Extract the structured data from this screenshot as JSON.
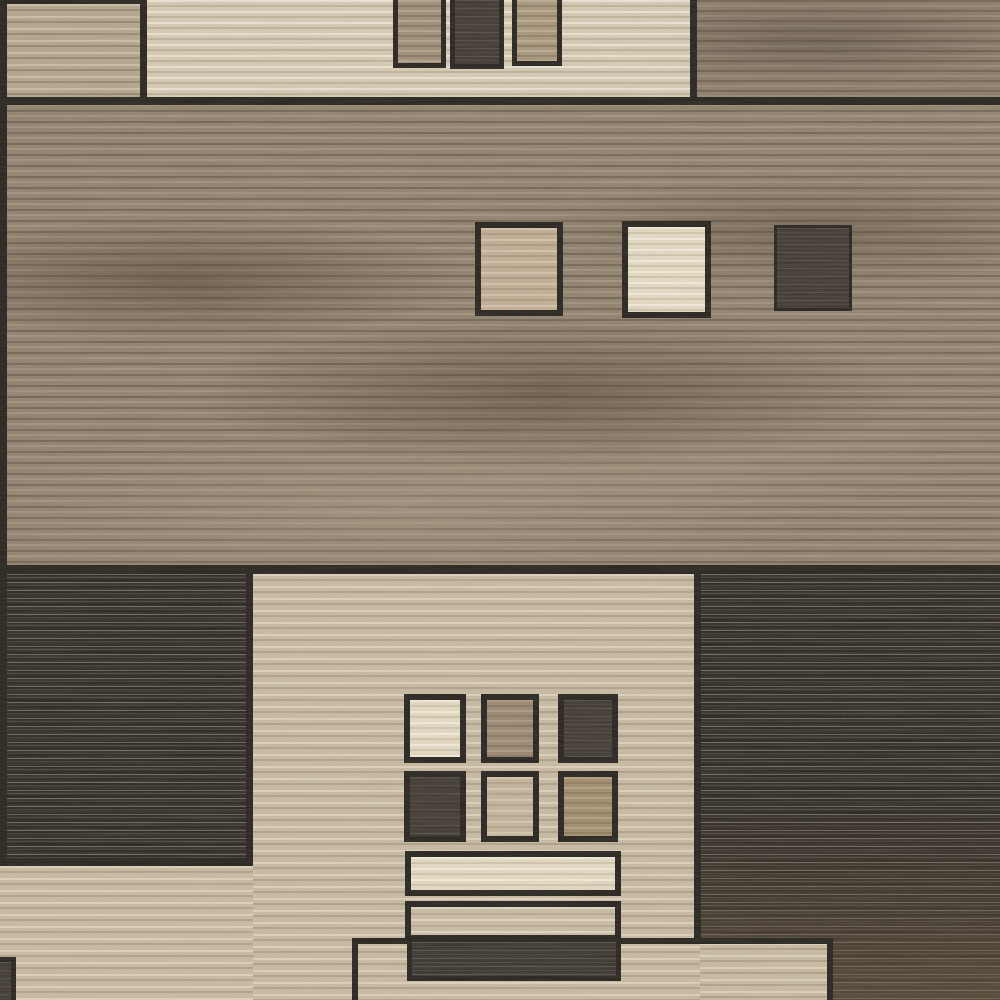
{
  "meta": {
    "subject": "close-up photo of a geometric patchwork area rug",
    "pattern": "rectangular color blocks with small inset squares and bars, woven horizontal striations",
    "text_content": "none visible"
  },
  "palette": {
    "line": "#1d1812",
    "brown_field": "#8f7e69",
    "brown_field_top_right": "#877663",
    "cream_band": "#d8cbb1",
    "tan_block": "#b3a389",
    "beige_block": "#c9baa0",
    "charcoal_block": "#241e17",
    "charcoal_streak": "#c4bdb0",
    "cream_square": "#e7dcc2",
    "tan_square": "#c3ad92",
    "dark_square": "#362f27",
    "brown_square": "#9a846c",
    "light_taupe_square": "#c4b498",
    "mid_brown_square": "#a08967"
  },
  "regions": [
    {
      "name": "main-brown-field",
      "x": 0,
      "y": 99,
      "w": 1000,
      "h": 475,
      "tex": "brownfield",
      "z": 1
    },
    {
      "name": "top-right-brown-block",
      "x": 697,
      "y": 0,
      "w": 303,
      "h": 99,
      "tex": "brownfield2",
      "z": 1
    },
    {
      "name": "top-cream-band",
      "x": 147,
      "y": 0,
      "w": 550,
      "h": 99,
      "tex": "cream",
      "z": 1,
      "br": 7
    },
    {
      "name": "top-left-tan-block",
      "x": 0,
      "y": 0,
      "w": 147,
      "h": 99,
      "tex": "tan",
      "z": 1,
      "bt": 4,
      "bl": 7,
      "br": 7
    },
    {
      "name": "bottom-left-charcoal-block",
      "x": 0,
      "y": 574,
      "w": 253,
      "h": 292,
      "tex": "charcoal",
      "z": 1,
      "br": 7,
      "bb": 8
    },
    {
      "name": "bottom-center-beige-block",
      "x": 253,
      "y": 574,
      "w": 447,
      "h": 426,
      "tex": "beige",
      "z": 1
    },
    {
      "name": "bottom-right-charcoal-block",
      "x": 700,
      "y": 574,
      "w": 300,
      "h": 426,
      "tex": "charcoalbrown",
      "z": 1
    },
    {
      "name": "bottom-left-beige-area",
      "x": 0,
      "y": 866,
      "w": 253,
      "h": 134,
      "tex": "beige",
      "z": 1
    },
    {
      "name": "divider-line-top",
      "x": 0,
      "y": 97,
      "w": 1000,
      "h": 8,
      "tex": "line",
      "z": 2
    },
    {
      "name": "divider-line-middle",
      "x": 0,
      "y": 565,
      "w": 1000,
      "h": 9,
      "tex": "line",
      "z": 2
    },
    {
      "name": "left-edge-line",
      "x": 0,
      "y": 0,
      "w": 7,
      "h": 866,
      "tex": "line",
      "z": 2
    },
    {
      "name": "center-block-right-line",
      "x": 694,
      "y": 574,
      "w": 7,
      "h": 369,
      "tex": "line",
      "z": 2
    },
    {
      "name": "bottom-right-beige-patch",
      "x": 700,
      "y": 943,
      "w": 133,
      "h": 57,
      "tex": "beige",
      "z": 2
    },
    {
      "name": "top-band-square-taupe",
      "x": 393,
      "y": 0,
      "w": 53,
      "h": 68,
      "tex": "topsq",
      "z": 3,
      "bl": 5,
      "br": 5,
      "bb": 5
    },
    {
      "name": "top-band-square-dark",
      "x": 450,
      "y": 0,
      "w": 54,
      "h": 69,
      "tex": "darksq",
      "z": 3,
      "bl": 5,
      "br": 5,
      "bb": 5
    },
    {
      "name": "top-band-square-taupe-2",
      "x": 512,
      "y": 0,
      "w": 50,
      "h": 66,
      "tex": "topsq2",
      "z": 3,
      "bl": 5,
      "br": 5,
      "bb": 5
    },
    {
      "name": "field-square-tan",
      "x": 475,
      "y": 222,
      "w": 88,
      "h": 94,
      "tex": "tansq",
      "z": 3,
      "bt": 6,
      "br": 6,
      "bb": 6,
      "bl": 6
    },
    {
      "name": "field-square-cream",
      "x": 622,
      "y": 221,
      "w": 89,
      "h": 97,
      "tex": "creamsq",
      "z": 3,
      "bt": 6,
      "br": 6,
      "bb": 6,
      "bl": 6
    },
    {
      "name": "field-square-dark",
      "x": 774,
      "y": 225,
      "w": 78,
      "h": 86,
      "tex": "darksq",
      "z": 3,
      "bt": 3,
      "br": 3,
      "bb": 3,
      "bl": 3
    },
    {
      "name": "bottom-outlined-rect",
      "x": 352,
      "y": 938,
      "w": 481,
      "h": 62,
      "tex": "none",
      "z": 3,
      "bt": 6,
      "bl": 6,
      "br": 6
    },
    {
      "name": "grid-square-r1c1-cream",
      "x": 404,
      "y": 694,
      "w": 62,
      "h": 69,
      "tex": "creamsq",
      "z": 4,
      "bt": 6,
      "br": 6,
      "bb": 6,
      "bl": 6
    },
    {
      "name": "grid-square-r1c2-brown",
      "x": 481,
      "y": 694,
      "w": 58,
      "h": 69,
      "tex": "brownsq",
      "z": 4,
      "bt": 6,
      "br": 6,
      "bb": 6,
      "bl": 6
    },
    {
      "name": "grid-square-r1c3-dark",
      "x": 558,
      "y": 694,
      "w": 60,
      "h": 69,
      "tex": "darksq",
      "z": 4,
      "bt": 6,
      "br": 6,
      "bb": 6,
      "bl": 6
    },
    {
      "name": "grid-square-r2c1-dark",
      "x": 404,
      "y": 771,
      "w": 62,
      "h": 71,
      "tex": "darksq",
      "z": 4,
      "bt": 6,
      "br": 6,
      "bb": 6,
      "bl": 6
    },
    {
      "name": "grid-square-r2c2-taupe",
      "x": 481,
      "y": 771,
      "w": 58,
      "h": 71,
      "tex": "lighttaupe",
      "z": 4,
      "bt": 6,
      "br": 6,
      "bb": 6,
      "bl": 6
    },
    {
      "name": "grid-square-r2c3-midbrown",
      "x": 558,
      "y": 771,
      "w": 60,
      "h": 71,
      "tex": "midbrown",
      "z": 4,
      "bt": 6,
      "br": 6,
      "bb": 6,
      "bl": 6
    },
    {
      "name": "bottom-bar-cream",
      "x": 405,
      "y": 851,
      "w": 216,
      "h": 45,
      "tex": "creamsq",
      "z": 4,
      "bt": 6,
      "br": 6,
      "bb": 6,
      "bl": 6
    },
    {
      "name": "bottom-bar-taupe",
      "x": 405,
      "y": 901,
      "w": 216,
      "h": 40,
      "tex": "beigelight",
      "z": 4,
      "bt": 6,
      "br": 6,
      "bb": 6,
      "bl": 6
    },
    {
      "name": "bottom-bar-dark",
      "x": 407,
      "y": 937,
      "w": 214,
      "h": 44,
      "tex": "darkbar",
      "z": 5,
      "bt": 5,
      "br": 5,
      "bb": 5,
      "bl": 5
    },
    {
      "name": "bottom-left-corner-square",
      "x": 0,
      "y": 957,
      "w": 16,
      "h": 43,
      "tex": "darksq",
      "z": 5,
      "bt": 5,
      "br": 5
    }
  ]
}
